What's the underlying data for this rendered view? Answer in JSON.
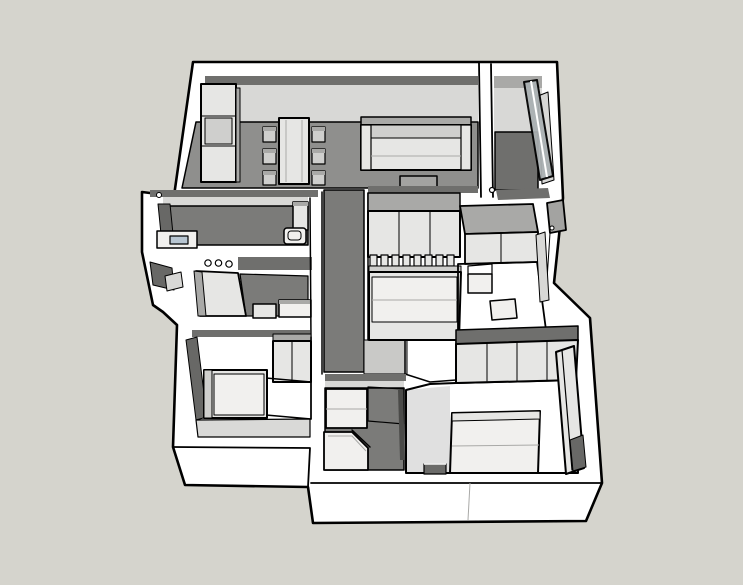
{
  "viewport": {
    "type": "3d-axonometric-floorplan-render",
    "style": "sketchup-white-model",
    "background": "#d5d4cd"
  },
  "colors": {
    "background": "#d5d4cd",
    "outline": "#000000",
    "wallWhite": "#ffffff",
    "wallFront": "#fbfbfa",
    "wallTopDark": "#6f6f6d",
    "innerLight": "#d8d8d6",
    "innerMid": "#a9a9a7",
    "innerDark": "#686866",
    "floorConcrete": "#8f8f8d",
    "floorBath": "#7b7b79",
    "floorBalcony": "#6f6f6d",
    "floorLight": "#c9c9c7",
    "floorPale": "#d9d9d7",
    "woodLight": "#a18977",
    "woodLightLine": "#85705f",
    "woodDark": "#6f6257",
    "woodDarkLine": "#5b5147",
    "furnitureLight": "#e6e6e4",
    "furnitureMid": "#cfcfcd",
    "furnitureDark": "#a3a3a1",
    "bedWhite": "#f1f0ee",
    "glass": "#aab0b2",
    "sinkBlue": "#b7c5d1",
    "benchDark": "#6b6b69",
    "doorGray": "#a3a3a1",
    "glassDoorDark": "#4a4a48"
  },
  "scene": {
    "rooms": [
      {
        "id": "open-kitchen-dining-living",
        "floor": "concrete-gray",
        "contents": [
          "tall-kitchen-cabinets",
          "dining-table",
          "6-chairs",
          "sofa",
          "tv-console"
        ]
      },
      {
        "id": "balcony",
        "floor": "dark-gray",
        "contents": [
          "sliding-glass-door"
        ]
      },
      {
        "id": "bathroom-1",
        "floor": "dark-gray",
        "contents": [
          "vanity",
          "sink",
          "mirror",
          "toilet",
          "cabinet"
        ]
      },
      {
        "id": "bathroom-2",
        "floor": "dark-gray",
        "contents": [
          "walk-in-shower-glass",
          "counter",
          "toilet",
          "ceiling-lights"
        ]
      },
      {
        "id": "corridor",
        "floor": "dark-gray",
        "contents": []
      },
      {
        "id": "bedroom-center",
        "floor": "light-gray",
        "contents": [
          "wardrobe",
          "slat-headboard-bed"
        ]
      },
      {
        "id": "entry-dressing",
        "floor": "herringbone-wood",
        "contents": [
          "closet",
          "stool",
          "side-table"
        ]
      },
      {
        "id": "bedroom-left",
        "floor": "herringbone-wood",
        "contents": [
          "bed",
          "wardrobe"
        ]
      },
      {
        "id": "ensuite-bathroom",
        "floor": "dark-gray",
        "contents": [
          "vanity",
          "corner-shower",
          "glass-partition"
        ]
      },
      {
        "id": "master-bedroom",
        "floor": "herringbone-wood",
        "contents": [
          "double-bed",
          "full-width-closet",
          "low-bench",
          "glazed-balcony-door"
        ]
      }
    ],
    "fixtures": [
      "front-door",
      "door-handle-markers",
      "bay-window-niche"
    ]
  }
}
